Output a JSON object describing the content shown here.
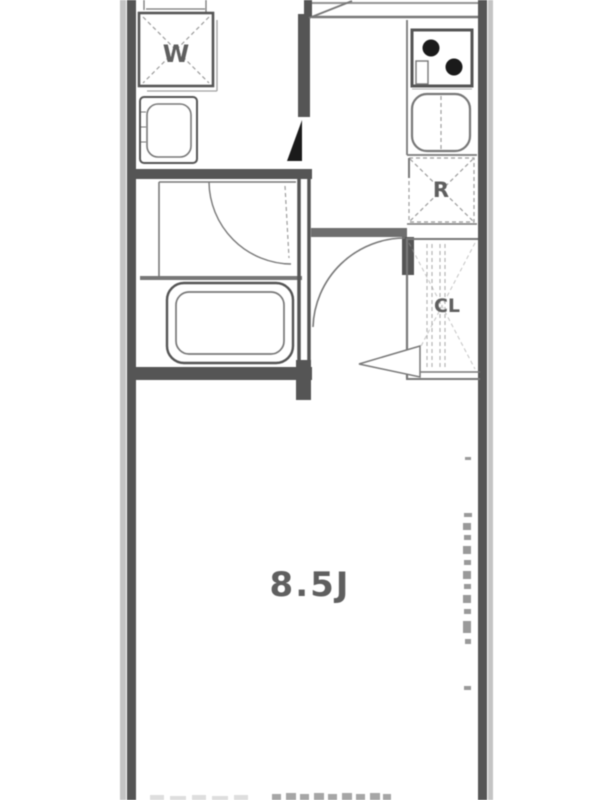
{
  "floorplan": {
    "labels": {
      "washing_machine": "W",
      "refrigerator": "R",
      "closet": "CL",
      "main_room_size": "8.5J"
    },
    "colors": {
      "wall": "#555555",
      "line": "#787878",
      "dash": "#9c9c9c",
      "text": "#5f5f5f",
      "edge": "#c4c4c4",
      "burner": "#1a1a1a",
      "bg": "#ffffff"
    }
  }
}
